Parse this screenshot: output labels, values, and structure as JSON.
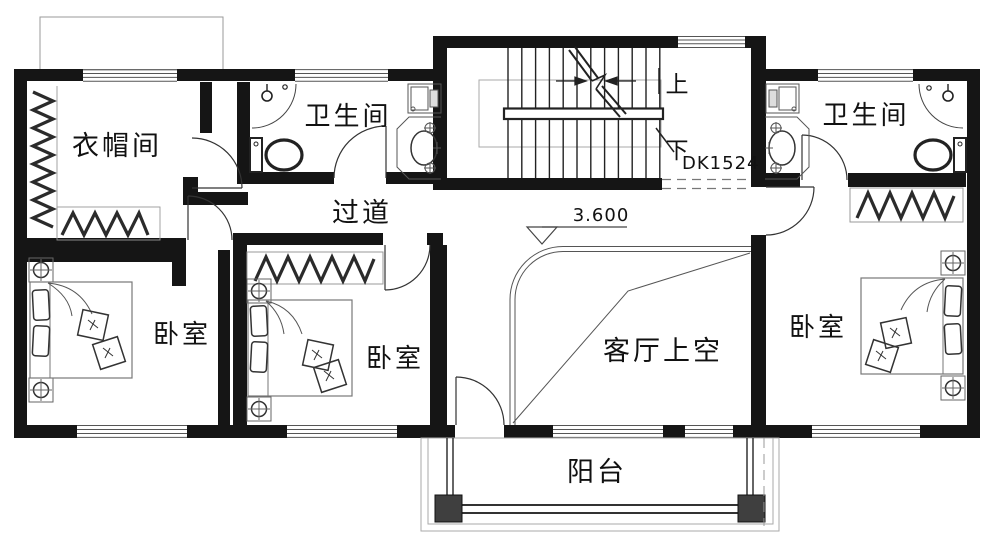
{
  "plan": {
    "title": "second-floor-plan",
    "rooms": {
      "cloakroom": "衣帽间",
      "bath_left": "卫生间",
      "bath_right": "卫生间",
      "corridor": "过道",
      "bedroom_left": "卧室",
      "bedroom_middle": "卧室",
      "bedroom_right": "卧室",
      "living_void": "客厅上空",
      "balcony": "阳台"
    },
    "stairs": {
      "up": "上",
      "down": "下",
      "code": "DK1524"
    },
    "elevation": "3.600",
    "colors": {
      "wall": "#151515",
      "fixture": "#2b2b2b",
      "thin_line": "#999999",
      "annotation": "#8a8a8a"
    }
  }
}
